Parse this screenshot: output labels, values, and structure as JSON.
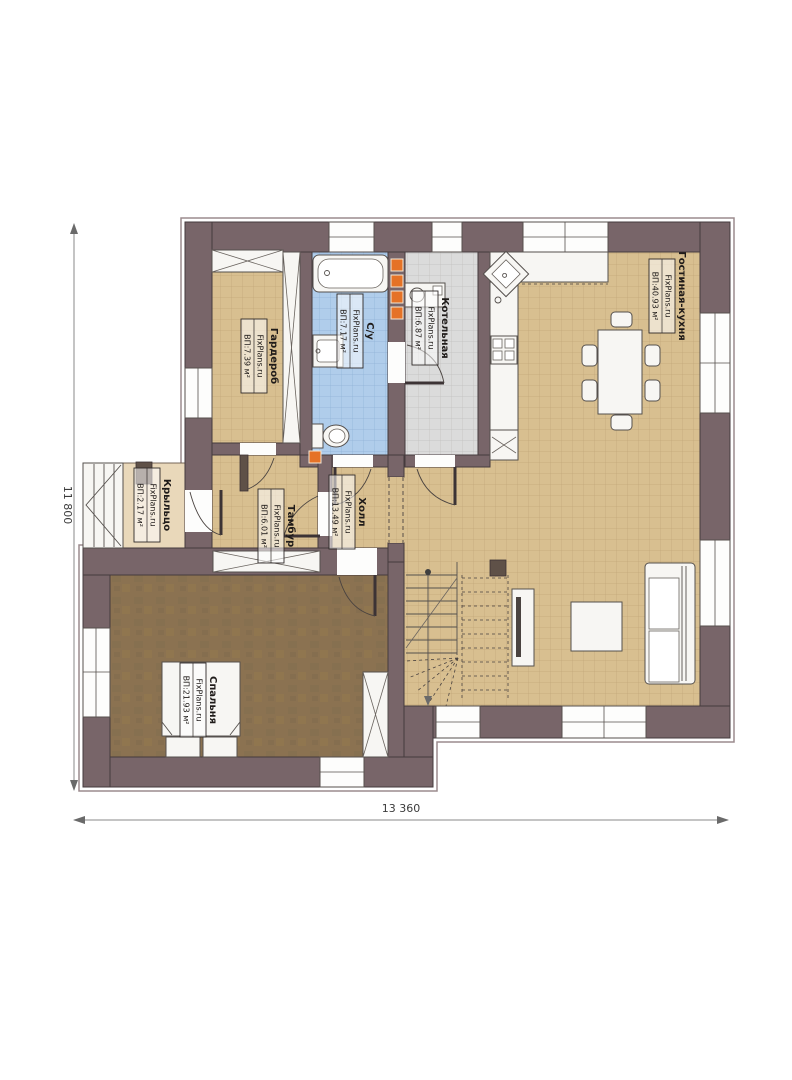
{
  "plan": {
    "watermark": "FixPlans.ru",
    "dimensions": {
      "width_mm": "13 360",
      "height_mm": "11 800"
    },
    "rooms": {
      "living": {
        "name": "Гостиная-кухня",
        "area": "ВП:40.93 м²"
      },
      "boiler": {
        "name": "Котельная",
        "area": "ВП:6.87 м²"
      },
      "bathroom": {
        "name": "С/у",
        "area": "ВП:7.17 м²"
      },
      "wardrobe": {
        "name": "Гардероб",
        "area": "ВП:7.39 м²"
      },
      "hall": {
        "name": "Холл",
        "area": "ВП:13.49 м²"
      },
      "vestibule": {
        "name": "Тамбур",
        "area": "ВП:6.01 м²"
      },
      "porch": {
        "name": "Крыльцо",
        "area": "ВП:2.17 м²"
      },
      "bedroom": {
        "name": "Спальня",
        "area": "ВП:21.93 м²"
      }
    },
    "colors": {
      "wall": "#786569",
      "floor_tile": "#d8bf90",
      "bath_tile": "#b0cdeb",
      "boiler_tile": "#dbdbdb",
      "bedroom_floor": "#8b7251",
      "accent_orange": "#e57226"
    }
  }
}
